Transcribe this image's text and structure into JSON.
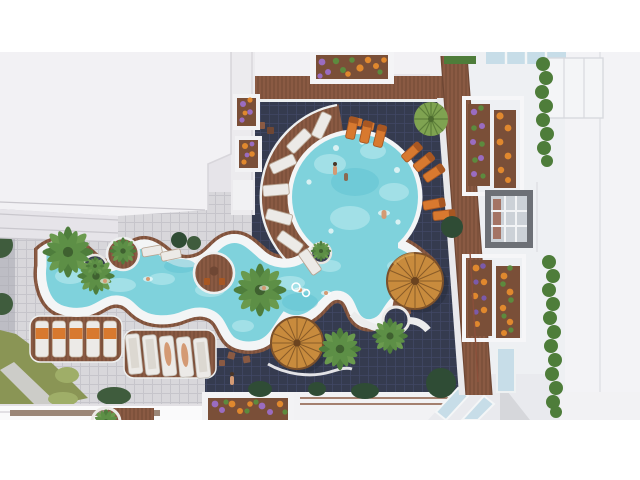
{
  "scene": {
    "description": "Aerial 3D architectural rendering of a residential resort courtyard with a free-form lazy-river swimming pool, a round lagoon pool, sun loungers, wicker parasols, palm trees, lawns and planted balconies.",
    "labels": {
      "roof": "Main building roof",
      "plaza": "Paved plaza tiles",
      "courtyard": "Dark tiled pool courtyard",
      "pool": "Free-form lazy-river pool",
      "round_pool": "Round lagoon pool",
      "umbrella_large": "Large wicker parasol",
      "umbrella_small": "Wicker parasol",
      "palms": "Palm trees",
      "round_tree": "Clipped round tree",
      "loungers_orange": "Orange sun loungers",
      "loungers_white": "White sun loungers",
      "radial_loungers": "Radial deck loungers",
      "planters": "Flower planters",
      "hedges": "Balcony hedges",
      "skylight": "Skylight window",
      "grass": "Lawn with footpath",
      "right_building": "Balconied apartment building",
      "wood_deck": "Timber pool deck",
      "swimmers": "Swimmers",
      "walkway": "White walkway"
    }
  },
  "colors": {
    "letterbox": "#ffffff",
    "roof_white": "#f2f1f4",
    "roof_band": "#e6e4e9",
    "roof_line": "#c9c7cd",
    "wall_strip": "#ecebee",
    "building_right": "#eef0f3",
    "building_far_right": "#f3f3f6",
    "panel_line": "#dcdde2",
    "plaza_tile": "#d8d7db",
    "plaza_dark_strip": "#a7a8b0",
    "dark_tile": "#353b4f",
    "wood": "#8a5a43",
    "wood_dark": "#6f4734",
    "coping": "#f3f5f6",
    "water": "#7fd2dc",
    "water_light": "#c0ecf0",
    "water_deep": "#5fc2d2",
    "grass": "#8a9555",
    "grass_light": "#9fae68",
    "bush_dark": "#2f4c35",
    "bush_mid": "#3f5c3d",
    "tree_round": "#7fa351",
    "tree_round_line": "#5d7f3a",
    "palm_dark": "#4e7d3c",
    "palm_light": "#6a9a4e",
    "umbrella": "#c88b3d",
    "umbrella_spoke": "#8a5c28",
    "umbrella_rim": "#7a4f2a",
    "lounger_white": "#eceae7",
    "lounger_frame": "#b7a492",
    "towel_orange": "#d8792f",
    "towel_orange_dark": "#a85722",
    "planter_soil": "#7a4f38",
    "flower_orange": "#e0882e",
    "flower_purple": "#9a6cc0",
    "flower_violet": "#7b5aa8",
    "flower_green": "#5d8a3e",
    "hedge": "#4e7d3a",
    "glass": "#c7dde8",
    "skylight_frame": "#6d7076",
    "skylight_glass": "#ccd1d7",
    "skin": "#d49a74",
    "path_light": "#d3d1d5",
    "shadow": "#1c2230"
  }
}
